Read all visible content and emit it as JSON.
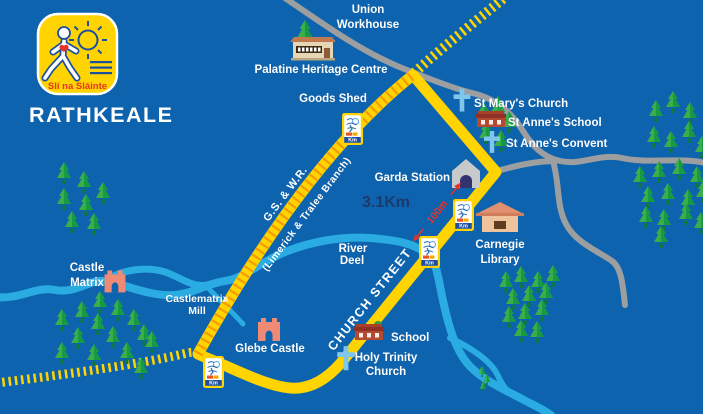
{
  "map": {
    "region_title": "RATHKEALE",
    "logo_text": "Slí na Sláinte",
    "route_length": "3.1Km",
    "segment_length": "100m",
    "km_marker_label": "Km",
    "railway_name": "G.S. & W.R.",
    "railway_branch": "(Limerick & Tralee Branch)",
    "street_name": "CHURCH STREET",
    "river": {
      "line1": "River",
      "line2": "Deel"
    },
    "places": {
      "union_workhouse_1": "Union",
      "union_workhouse_2": "Workhouse",
      "palatine_heritage_centre": "Palatine Heritage Centre",
      "goods_shed": "Goods Shed",
      "st_marys_church": "St Mary's Church",
      "st_annes_school": "St Anne's School",
      "st_annes_convent": "St Anne's Convent",
      "garda_station": "Garda Station",
      "carnegie_1": "Carnegie",
      "carnegie_2": "Library",
      "castle_matrix_1": "Castle",
      "castle_matrix_2": "Matrix",
      "castlematrix_mill_1": "Castlematrix",
      "castlematrix_mill_2": "Mill",
      "glebe_castle": "Glebe Castle",
      "school": "School",
      "holy_trinity_1": "Holy Trinity",
      "holy_trinity_2": "Church"
    },
    "colors": {
      "background": "#0d63ad",
      "route_yellow": "#ffd400",
      "railway_tie_orange": "#f59b00",
      "river_blue": "#2aabe2",
      "road_gray": "#9c9ea0",
      "label_white": "#ffffff",
      "distance_navy": "#1c3a6e",
      "measure_red": "#e5332a",
      "tree_green": "#3cae49",
      "church_cross_blue": "#7ec7ea",
      "castle_salmon": "#ef8a75"
    }
  }
}
